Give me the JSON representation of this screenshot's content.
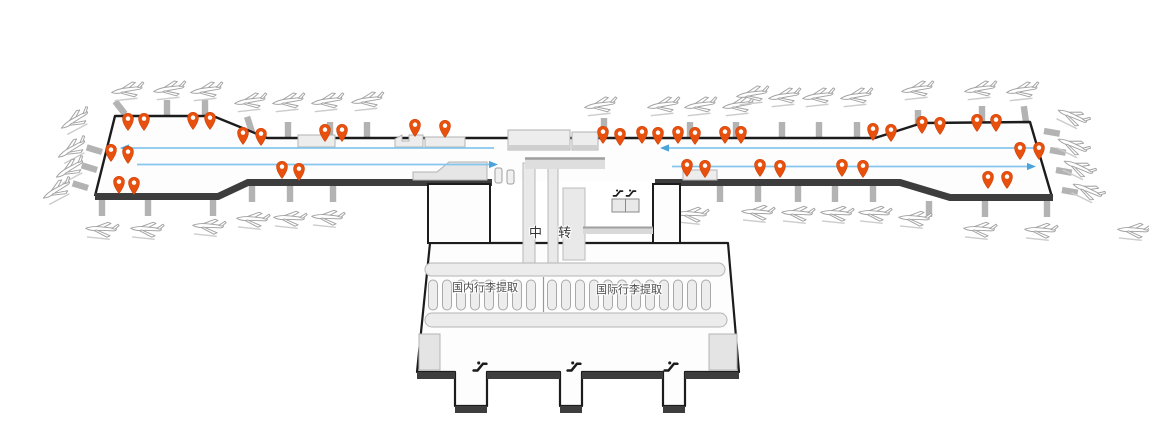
{
  "labels": {
    "transfer": "中 转",
    "domestic_baggage_claim": "国内行李提取",
    "international_baggage_claim": "国际行李提取"
  },
  "colors": {
    "pin": "#e8500e",
    "pin_stroke": "#cf4106",
    "pin_hole": "#ffffff",
    "flow_line": "#85c6ec",
    "flow_arrow": "#4ba3da",
    "outline": "#1c1c1c",
    "band": "#3d3d3d",
    "terminal_fill": "#fdfdfd",
    "block_fill": "#ededed",
    "block_edge": "#b2b2b2",
    "bridge": "#b3b3b3",
    "plane_stroke": "#a3a3a3"
  },
  "map": {
    "pins": [
      [
        128,
        131
      ],
      [
        144,
        131
      ],
      [
        193,
        130
      ],
      [
        210,
        130
      ],
      [
        243,
        145
      ],
      [
        261,
        146
      ],
      [
        325,
        142
      ],
      [
        342,
        142
      ],
      [
        415,
        137
      ],
      [
        445,
        138
      ],
      [
        111,
        162
      ],
      [
        128,
        164
      ],
      [
        119,
        194
      ],
      [
        134,
        195
      ],
      [
        282,
        179
      ],
      [
        299,
        181
      ],
      [
        603,
        144
      ],
      [
        620,
        146
      ],
      [
        642,
        144
      ],
      [
        658,
        145
      ],
      [
        678,
        144
      ],
      [
        695,
        145
      ],
      [
        725,
        144
      ],
      [
        741,
        144
      ],
      [
        873,
        141
      ],
      [
        891,
        142
      ],
      [
        922,
        134
      ],
      [
        940,
        135
      ],
      [
        977,
        132
      ],
      [
        996,
        132
      ],
      [
        1020,
        160
      ],
      [
        1039,
        160
      ],
      [
        687,
        177
      ],
      [
        705,
        178
      ],
      [
        760,
        177
      ],
      [
        780,
        178
      ],
      [
        842,
        177
      ],
      [
        863,
        178
      ],
      [
        988,
        189
      ],
      [
        1007,
        189
      ]
    ],
    "planes": [
      [
        127,
        91,
        -6
      ],
      [
        169,
        90,
        -6
      ],
      [
        206,
        91,
        -6
      ],
      [
        250,
        102,
        -6
      ],
      [
        288,
        102,
        -6
      ],
      [
        327,
        102,
        -6
      ],
      [
        367,
        101,
        -6
      ],
      [
        75,
        121,
        -28
      ],
      [
        72,
        150,
        -28
      ],
      [
        70,
        170,
        -28
      ],
      [
        57,
        191,
        -28
      ],
      [
        101,
        230,
        6
      ],
      [
        146,
        230,
        6
      ],
      [
        208,
        227,
        6
      ],
      [
        252,
        220,
        6
      ],
      [
        289,
        219,
        6
      ],
      [
        327,
        218,
        6
      ],
      [
        600,
        106,
        -6
      ],
      [
        663,
        106,
        -6
      ],
      [
        700,
        106,
        -6
      ],
      [
        738,
        106,
        -6
      ],
      [
        752,
        95,
        -6
      ],
      [
        784,
        97,
        -6
      ],
      [
        818,
        97,
        -6
      ],
      [
        856,
        97,
        -6
      ],
      [
        917,
        90,
        -6
      ],
      [
        980,
        90,
        -6
      ],
      [
        1022,
        91,
        -6
      ],
      [
        1072,
        117,
        26
      ],
      [
        1072,
        146,
        26
      ],
      [
        1078,
        168,
        26
      ],
      [
        1087,
        191,
        26
      ],
      [
        691,
        215,
        6
      ],
      [
        757,
        213,
        6
      ],
      [
        797,
        214,
        6
      ],
      [
        836,
        214,
        6
      ],
      [
        874,
        214,
        6
      ],
      [
        914,
        219,
        6
      ],
      [
        979,
        230,
        6
      ],
      [
        1040,
        231,
        6
      ],
      [
        1133,
        231,
        6
      ]
    ],
    "bridges_top": [
      [
        125,
        114,
        -38
      ],
      [
        167,
        116,
        0
      ],
      [
        205,
        116,
        0
      ],
      [
        252,
        132,
        -18
      ],
      [
        288,
        138,
        0
      ],
      [
        330,
        138,
        0
      ],
      [
        367,
        138,
        0
      ],
      [
        604,
        134,
        0
      ],
      [
        690,
        138,
        0
      ],
      [
        736,
        138,
        0
      ],
      [
        782,
        138,
        0
      ],
      [
        819,
        138,
        0
      ],
      [
        857,
        138,
        0
      ],
      [
        918,
        126,
        0
      ],
      [
        982,
        122,
        0
      ],
      [
        1026,
        122,
        -8
      ],
      [
        102,
        152,
        -73
      ],
      [
        97,
        170,
        -73
      ],
      [
        88,
        188,
        -73
      ],
      [
        1044,
        131,
        100
      ],
      [
        1050,
        150,
        100
      ],
      [
        1056,
        170,
        100
      ],
      [
        1062,
        190,
        100
      ]
    ],
    "bridges_bottom": [
      [
        102,
        200,
        0
      ],
      [
        148,
        200,
        0
      ],
      [
        213,
        200,
        0
      ],
      [
        252,
        186,
        0
      ],
      [
        290,
        186,
        0
      ],
      [
        333,
        186,
        0
      ],
      [
        720,
        186,
        0
      ],
      [
        758,
        186,
        0
      ],
      [
        798,
        186,
        0
      ],
      [
        835,
        186,
        0
      ],
      [
        873,
        186,
        0
      ],
      [
        929,
        201,
        0
      ],
      [
        985,
        201,
        0
      ],
      [
        1047,
        201,
        0
      ]
    ],
    "flow_lines": [
      {
        "x1": 128,
        "y1": 148,
        "x2": 494,
        "y2": 148,
        "dir": "left"
      },
      {
        "x1": 137,
        "y1": 164.5,
        "x2": 490,
        "y2": 164.5,
        "dir": "right"
      },
      {
        "x1": 668,
        "y1": 148,
        "x2": 1043,
        "y2": 148,
        "dir": "left"
      },
      {
        "x1": 672,
        "y1": 166.5,
        "x2": 1028,
        "y2": 166.5,
        "dir": "right"
      }
    ],
    "carousels": [
      {
        "x": 433,
        "count": 8,
        "step": 14,
        "y": 280,
        "w": 9,
        "h": 30
      },
      {
        "x": 552,
        "count": 12,
        "step": 14,
        "y": 280,
        "w": 9,
        "h": 30
      }
    ],
    "exit_escalators": [
      [
        480,
        365
      ],
      [
        574,
        365
      ],
      [
        671,
        365
      ]
    ],
    "transfer_escalators": [
      [
        618,
        192
      ],
      [
        631,
        192
      ]
    ]
  }
}
